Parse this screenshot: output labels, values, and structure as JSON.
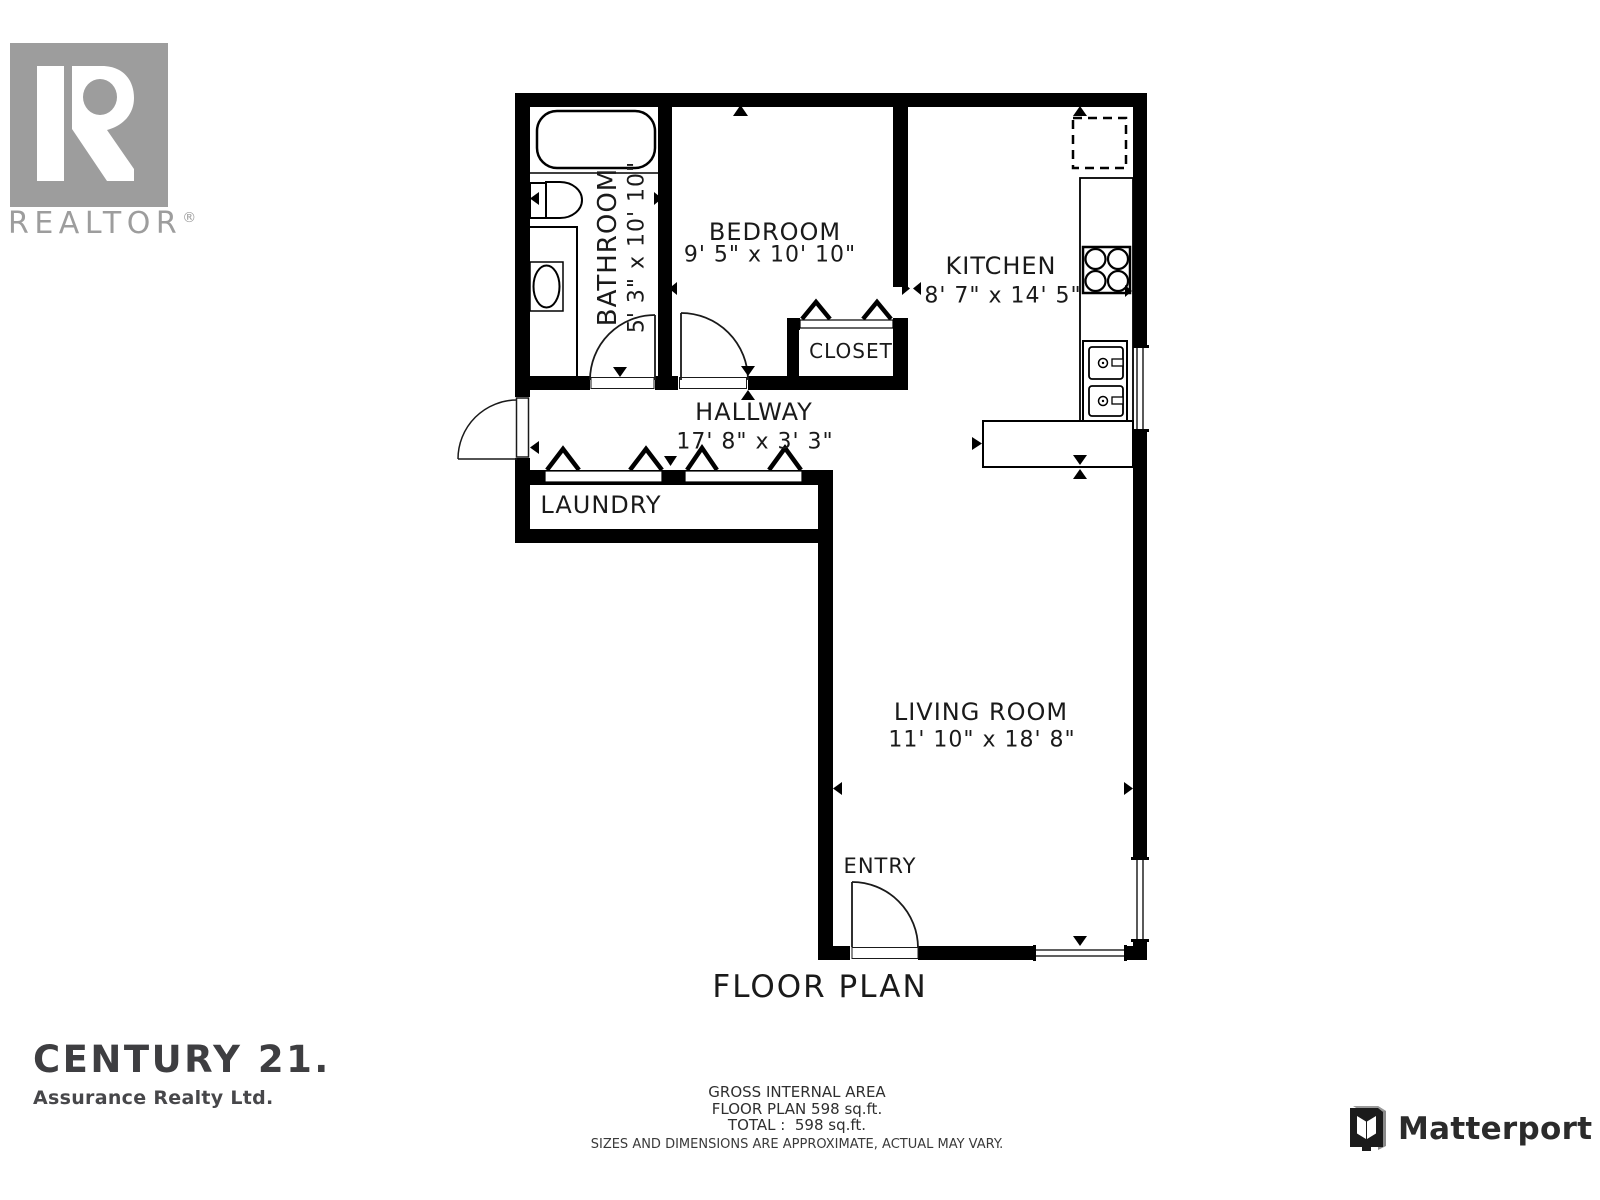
{
  "branding": {
    "realtor_word": "REALTOR",
    "realtor_reg": "®",
    "century21_title": "CENTURY 21.",
    "century21_subtitle": "Assurance Realty Ltd.",
    "matterport_name": "Matterport"
  },
  "plan": {
    "title": "FLOOR PLAN",
    "rooms": {
      "bathroom": {
        "name": "BATHROOM",
        "dims": "5' 3\" x 10' 10\""
      },
      "bedroom": {
        "name": "BEDROOM",
        "dims": "9' 5\" x 10' 10\""
      },
      "kitchen": {
        "name": "KITCHEN",
        "dims": "8' 7\" x 14' 5\""
      },
      "closet": {
        "name": "CLOSET",
        "dims": ""
      },
      "hallway": {
        "name": "HALLWAY",
        "dims": "17' 8\" x 3' 3\""
      },
      "laundry": {
        "name": "LAUNDRY",
        "dims": ""
      },
      "living_room": {
        "name": "LIVING ROOM",
        "dims": "11' 10\" x 18' 8\""
      },
      "entry": {
        "name": "ENTRY",
        "dims": ""
      }
    }
  },
  "footer": {
    "line1": "GROSS INTERNAL AREA",
    "line2": "FLOOR PLAN 598 sq.ft.",
    "line3": "TOTAL :  598 sq.ft.",
    "disclaimer": "SIZES AND DIMENSIONS ARE APPROXIMATE, ACTUAL MAY VARY."
  },
  "colors": {
    "wall": "#000000",
    "logo_gray": "#9d9d9d",
    "century_dark": "#3e3e41",
    "text_dark": "#1a1a1a"
  }
}
